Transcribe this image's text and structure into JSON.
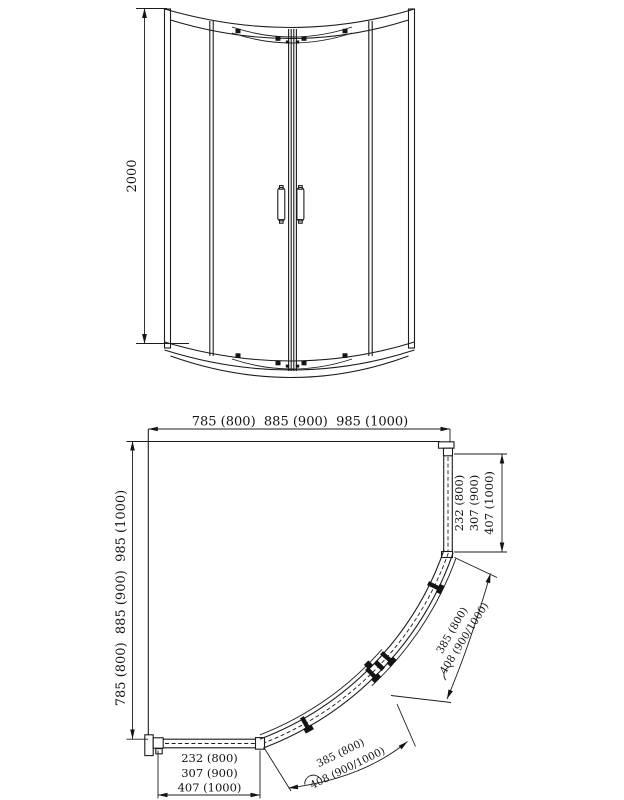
{
  "colors": {
    "line": "#1c1c1c",
    "background": "#ffffff"
  },
  "elevation": {
    "height_label": "2000"
  },
  "plan": {
    "width_label": "785 (800)  885 (900)  985 (1000)",
    "height_label": "785 (800)  885 (900)  985 (1000)",
    "right_panel_widths": [
      "232 (800)",
      "307 (900)",
      "407 (1000)"
    ],
    "bottom_panel_widths": [
      "232 (800)",
      "307 (900)",
      "407 (1000)"
    ],
    "door_arc_widths": [
      "385 (800)",
      "408 (900/1000)"
    ]
  }
}
